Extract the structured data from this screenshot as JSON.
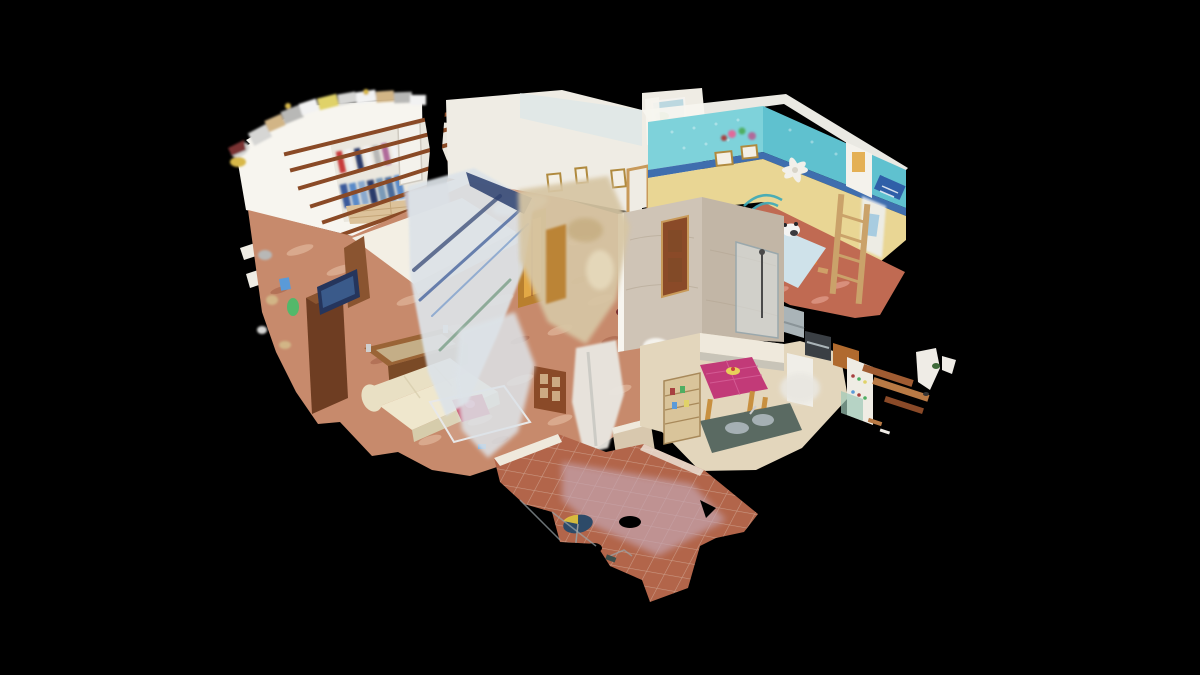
{
  "scene": {
    "type": "3d-dollhouse-view",
    "style": "photogrammetry-cutaway",
    "description": "Isometric Matterport-style dollhouse cutaway of a single-storey apartment floating on a black void; cut-open white walls reveal furnished rooms, pink marble and terracotta floors, exposed ceiling beams, turquoise kids bedroom, kitchen with magenta table, and ragged scan-edge fragments.",
    "rooms": [
      {
        "id": "wardrobe-bedroom",
        "label": "bedroom with open wardrobe and exposed ceiling beams",
        "position": "top-left"
      },
      {
        "id": "hallway",
        "label": "hallway with warm lit doorway and picture frames",
        "position": "top-center"
      },
      {
        "id": "window-room",
        "label": "small room with window and ceiling fan",
        "position": "top-center-right"
      },
      {
        "id": "kids-bedroom",
        "label": "turquoise children's bedroom with ceiling fan, bed and bunk ladder",
        "position": "top-right"
      },
      {
        "id": "master-bedroom",
        "label": "bedroom with bed, wooden dresser and TV",
        "position": "center-left"
      },
      {
        "id": "living-room",
        "label": "living room with cream sofa, wooden chest and glass dining table",
        "position": "center"
      },
      {
        "id": "bathroom",
        "label": "bathroom with marble shower enclosure",
        "position": "center-right"
      },
      {
        "id": "kitchen",
        "label": "kitchen with magenta-cloth dining table and appliances",
        "position": "right"
      },
      {
        "id": "terrace",
        "label": "terracotta-tiled terrace with parasol",
        "position": "bottom"
      }
    ],
    "palette": {
      "bg": "#000000",
      "wallWhite": "#efece4",
      "wallBright": "#f7f5ef",
      "wallBlueTint": "#d9e6e8",
      "wardrobeInner": "#eae7de",
      "hallFloorWood": "#dcc29a",
      "plankLine": "#bb9a6a",
      "beamBrown": "#8a4a26",
      "doorWood": "#8a4a28",
      "doorWoodLight": "#c89a5a",
      "doorWhite": "#f4f2ec",
      "doorWarmGlow": "#e2a845",
      "doorWarmDeep": "#b97f2e",
      "frameGold": "#b08a3e",
      "pictureMat": "#f4f0e6",
      "floorMarble": "#c78a6c",
      "marbleLight": "#e9c3a8",
      "marbleDark": "#a05c44",
      "kidsFloor": "#c06a52",
      "kidsFloorLight": "#e8a898",
      "cyanWall": "#7ed2da",
      "cyanDeep": "#5fc1cf",
      "friezeBlue": "#3f6eae",
      "yellowBand": "#e9d694",
      "bedBlue": "#cfe2ea",
      "pillowWhite": "#eaf2f6",
      "pandaWhite": "#f4f4f2",
      "pandaDark": "#26262a",
      "headboardTeal": "#3aa8b8",
      "ladderWood": "#caa26a",
      "curtainWhite": "#eef0f2",
      "towelBlue": "#a8cce0",
      "plaqueBlue": "#2f5fa8",
      "fanWhite": "#f2f0ea",
      "fanHub": "#d8d4c8",
      "windowSky": "#bcd8e0",
      "windowRoof": "#c89070",
      "windowGreen": "#6a9a5a",
      "curtainCream": "#f6f4ee",
      "bedWhite": "#f3efe4",
      "bedShade": "#d8d2c2",
      "blanketLavender": "#c4bfc8",
      "headboardWood": "#8a5430",
      "dresserWood": "#6e3d22",
      "tvNavy": "#25355c",
      "tvScreen": "#3a5a8a",
      "vaseGreen": "#53b86a",
      "chestWood": "#9a6436",
      "chestFront": "#7a4a26",
      "chestGlass": "#c9b690",
      "chestTrim": "#cfcfcf",
      "sofaCream": "#e9e0c4",
      "sofaSeat": "#efe7cd",
      "sofaShade": "#d6ccab",
      "glassEdge": "#e8e8e8",
      "clothRed": "#c84060",
      "clothPink": "#e06a9a",
      "plantGreen": "#4f7a3a",
      "potBrown": "#8a4a30",
      "slabTanL": "#cfc4b6",
      "slabTanR": "#c2b6a6",
      "slabVein": "#b4a794",
      "showerGlass": "#dfe6e8",
      "showerFrame": "#9aa8ac",
      "fixtureDark": "#4a4a4a",
      "sanitaryWhite": "#f4f2ec",
      "lowWallTan": "#d8c8ae",
      "kitchenFloor": "#e3d6bc",
      "cabinetWhite": "#efe9dc",
      "counterGrey": "#c8c4b8",
      "steel": "#aab4b8",
      "steelDark": "#8a9498",
      "ovenDark": "#3a3f44",
      "cabinetOrange": "#b06a2e",
      "applianceWhite": "#f0eee8",
      "pantryWhite": "#efece4",
      "glassGreen": "#9ec9b8",
      "larderWood": "#d9c49a",
      "larderLine": "#a8895a",
      "magenta": "#c23a78",
      "magentaLight": "#d8639a",
      "fruitYellow": "#e8d05a",
      "fruitRed": "#c84040",
      "chairWood": "#c89040",
      "counterDark": "#5a6a62",
      "artifactGlass": "#dde3e8",
      "artifactBeige": "#d7c6a4",
      "artifactSwirlDark": "#c3aa7c",
      "artifactSwirlLight": "#e8ddc0",
      "artifactWhite": "#e9e7e1",
      "streakBlue": "#49659e",
      "streakNavy": "#2c3f6e",
      "streakLightBlue": "#7fa0cc",
      "streakGreen": "#5a8a6a",
      "streakGrey": "#c2c2bc",
      "tileTerracotta": "#b2654a",
      "tileBleached": "#c5a5b1",
      "tileGrout": "#ddc3b3",
      "thresholdWhite": "#efe9dc",
      "umbrellaNavy": "#2d4a68",
      "umbrellaYellow": "#e8c83a",
      "railGrey": "#9aa4a8",
      "tealBit": "#2e4a4a",
      "maroonBit": "#7a3030",
      "fragWoodA": "#a05c32",
      "fragWoodB": "#b97a45",
      "fragWoodC": "#8a4a28",
      "fragWhite": "#efece6",
      "fragGreen": "#3e6a3a",
      "fragDark": "#333333",
      "clutterGrey": "#b8b8b6",
      "clutterSilver": "#d6d6d4",
      "clutterYellow": "#e0d268",
      "clutterBlue": "#5a9ad8",
      "clutterGreen": "#4fae62",
      "clutterRed": "#a84040",
      "clutterTan": "#d2b586",
      "clutterGold": "#d8b84a",
      "clutterWhite": "#f2f2f2",
      "clutterPink": "#b06a9a",
      "clothesRed": "#c83a3a",
      "clothesNavy": "#2a3a6a",
      "clothesBlue1": "#3a5a9a",
      "clothesBlue2": "#5a8ac8",
      "clothesBlue3": "#8aa8cc",
      "clothesBlue4": "#7a9ab8",
      "clothesBlue5": "#4a6a9a",
      "toyTan": "#cfa068",
      "toyOrange": "#d87838"
    }
  }
}
